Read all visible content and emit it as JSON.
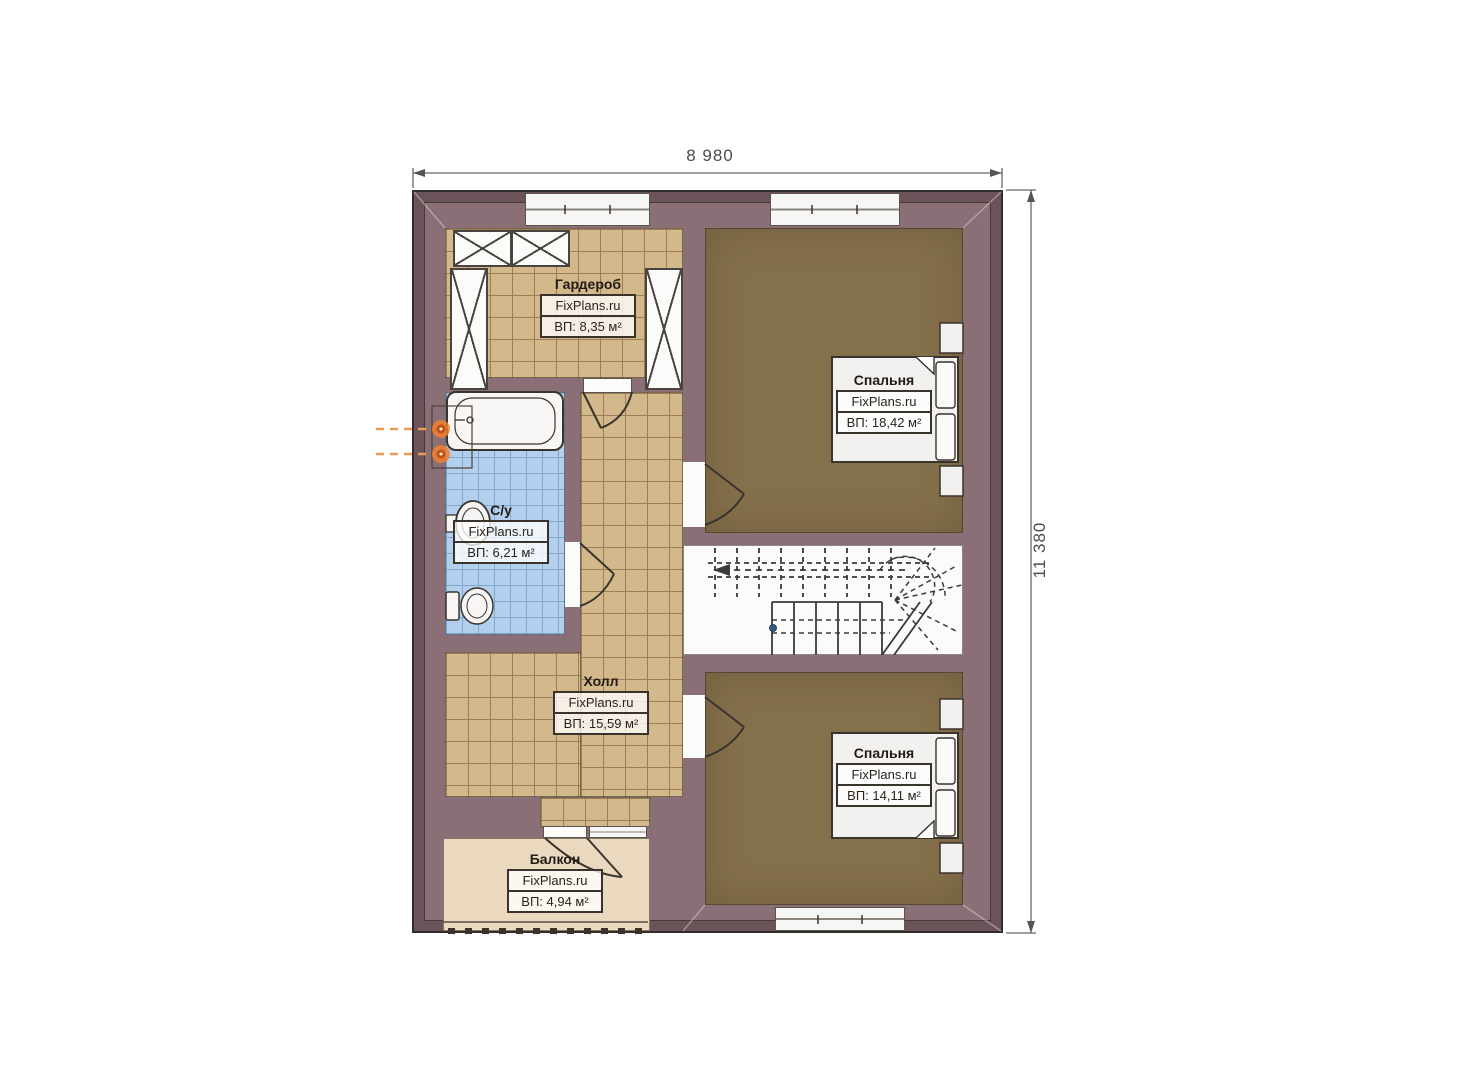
{
  "document": {
    "type": "floor-plan"
  },
  "dimensions": {
    "top": "8 980",
    "right": "11 380"
  },
  "brand": "FixPlans.ru",
  "rooms": [
    {
      "id": "wardrobe",
      "name": "Гардероб",
      "brand": "FixPlans.ru",
      "area": "ВП: 8,35 м²"
    },
    {
      "id": "bedroom-top",
      "name": "Спальня",
      "brand": "FixPlans.ru",
      "area": "ВП: 18,42 м²"
    },
    {
      "id": "bathroom",
      "name": "С/у",
      "brand": "FixPlans.ru",
      "area": "ВП: 6,21 м²"
    },
    {
      "id": "hall",
      "name": "Холл",
      "brand": "FixPlans.ru",
      "area": "ВП: 15,59 м²"
    },
    {
      "id": "bedroom-bottom",
      "name": "Спальня",
      "brand": "FixPlans.ru",
      "area": "ВП: 14,11 м²"
    },
    {
      "id": "balcony",
      "name": "Балкон",
      "brand": "FixPlans.ru",
      "area": "ВП: 4,94 м²"
    }
  ],
  "colors": {
    "wall_dark": "#6a545a",
    "wall_light": "#8a6f76",
    "floor_tile_tan": "#d3b88c",
    "floor_tile_blue": "#b2d0ee",
    "floor_bedroom": "#85704c",
    "floor_balcony": "#ead9bf",
    "plumbing_accent": "#e07a2a"
  }
}
